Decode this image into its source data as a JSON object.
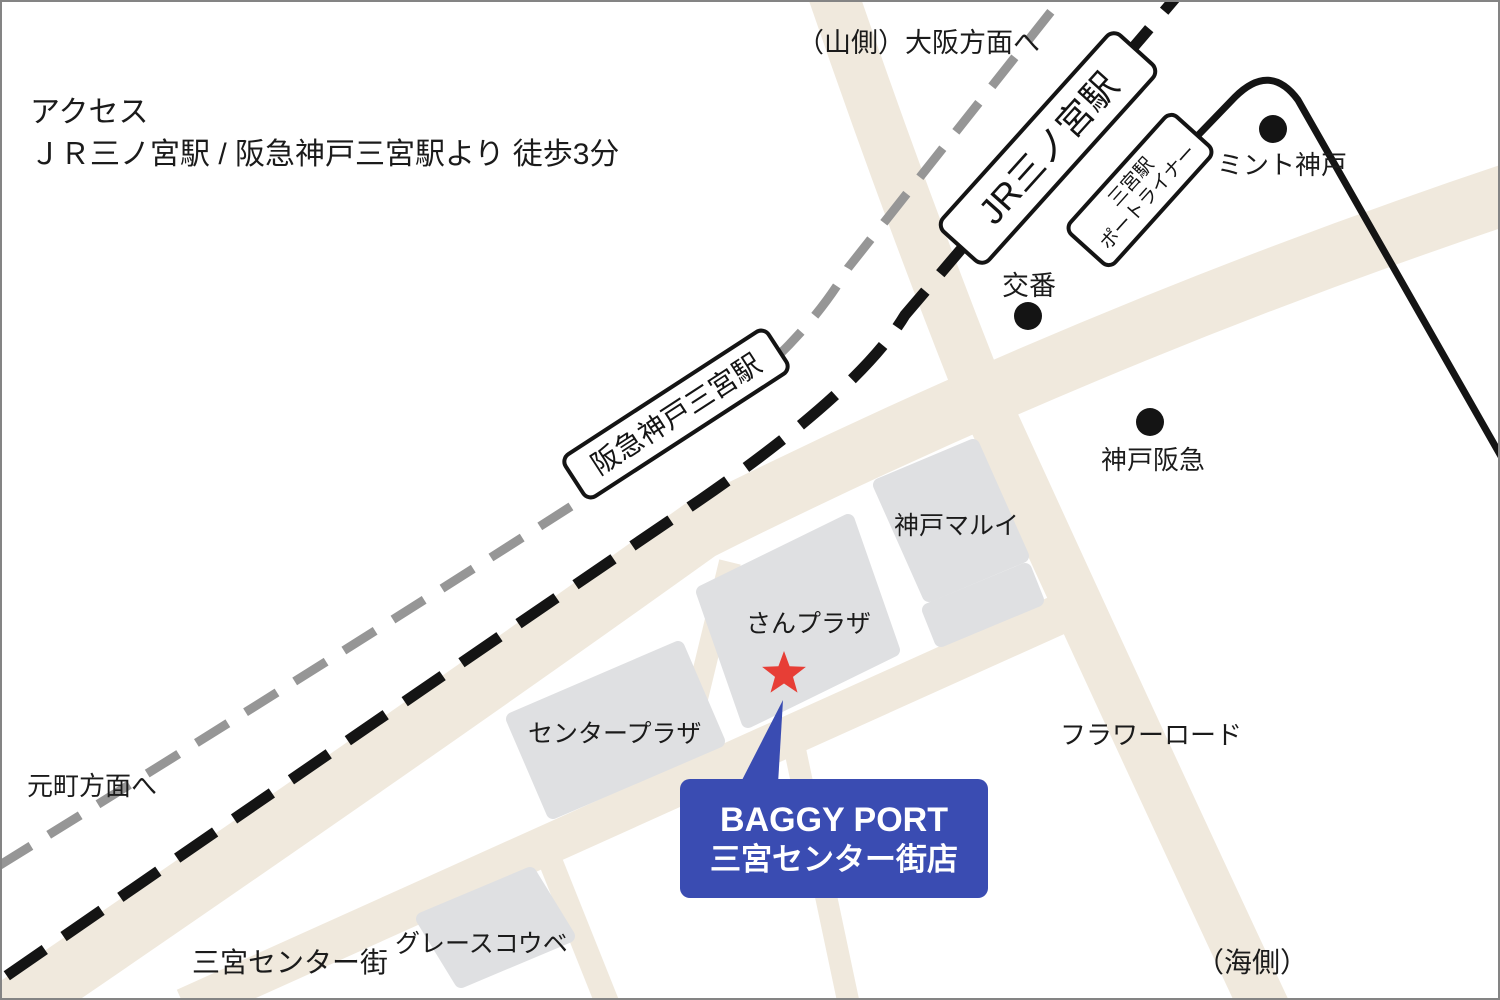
{
  "title": {
    "heading": "アクセス",
    "subtitle": "ＪＲ三ノ宮駅 / 阪急神戸三宮駅より 徒歩3分"
  },
  "stations": {
    "jr": "JR三ノ宮駅",
    "hankyu": "阪急神戸三宮駅",
    "portliner_line1": "三宮駅",
    "portliner_line2": "ポートライナー"
  },
  "directions": {
    "mountain_side": "（山側）",
    "to_osaka": "大阪方面へ",
    "to_motomachi": "元町方面へ",
    "sea_side": "（海側）"
  },
  "pois": {
    "mint_kobe": "ミント神戸",
    "koban": "交番",
    "kobe_hankyu": "神戸阪急",
    "kobe_marui": "神戸マルイ",
    "sanplaza": "さんプラザ",
    "center_plaza": "センタープラザ",
    "grace_kobe": "グレースコウベ"
  },
  "streets": {
    "sannomiya_center_gai": "三宮センター街",
    "flower_road": "フラワーロード"
  },
  "shop_callout": {
    "line1": "BAGGY PORT",
    "line2": "三宮センター街店"
  },
  "colors": {
    "road": "#f0e9dd",
    "building": "#dfe0e2",
    "rail_gray": "#969696",
    "ink": "#141414",
    "label": "#1b1b1b",
    "star_red": "#e73e36",
    "accent_blue": "#3a4cb2",
    "frame": "#848484"
  }
}
